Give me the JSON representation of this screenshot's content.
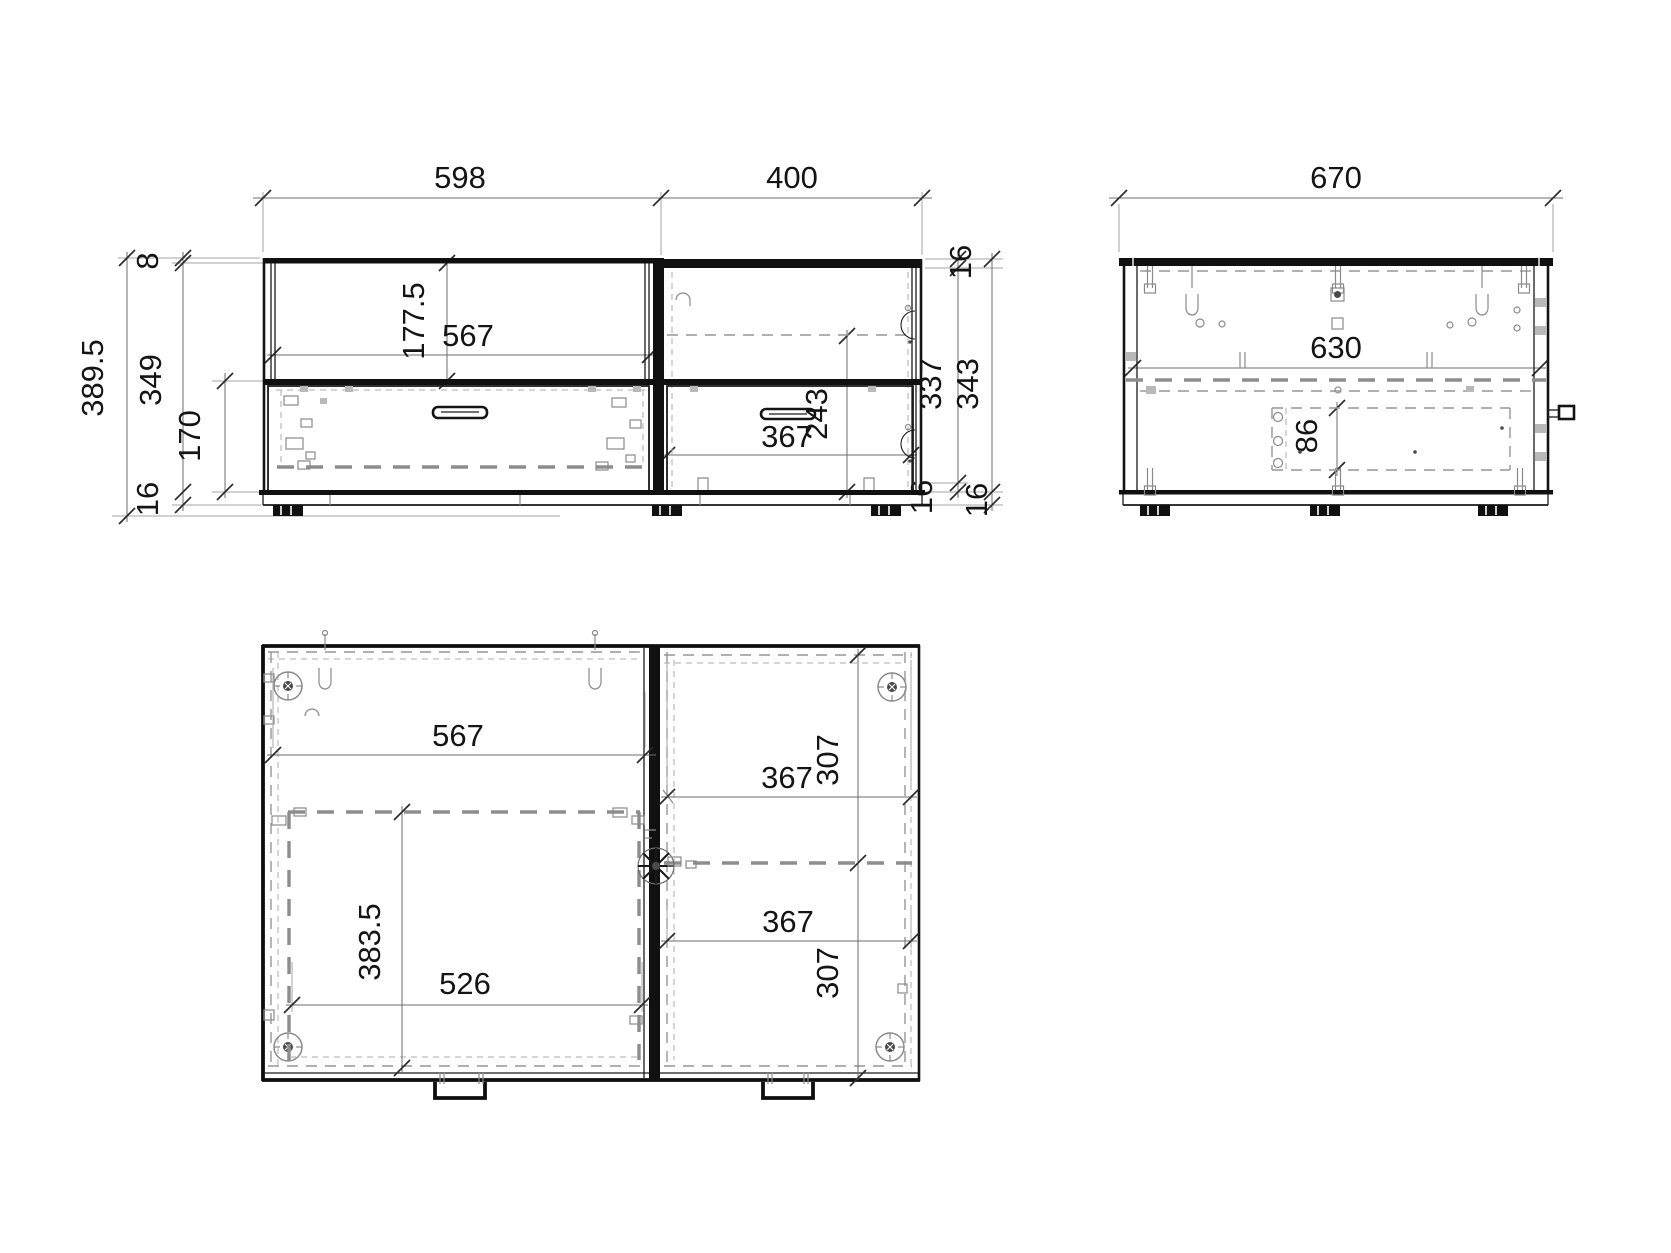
{
  "page": {
    "background": "#ffffff",
    "line_color": "#1a1a1a",
    "dash_color": "#969696"
  },
  "views": {
    "front": {
      "dims": {
        "w_left": "598",
        "w_right": "400",
        "top_panel": "8",
        "total_height": "389.5",
        "body_height": "349",
        "drawer_front": "170",
        "plinth_left": "16",
        "shelf_h": "177.5",
        "shelf_w": "567",
        "offset_top_right": "16",
        "inner_right": "337",
        "section_right": "343",
        "door_w": "367",
        "door_h": "243",
        "plinth_right_a": "16",
        "plinth_right_b": "16"
      }
    },
    "back": {
      "dims": {
        "w_total": "670",
        "w_inner": "630",
        "hw_height": "86"
      }
    },
    "plan": {
      "dims": {
        "inner_left": "567",
        "drawer_w": "526",
        "drawer_d": "383.5",
        "top_w": "367",
        "top_d": "307",
        "bot_w": "367",
        "bot_d": "307"
      }
    }
  }
}
